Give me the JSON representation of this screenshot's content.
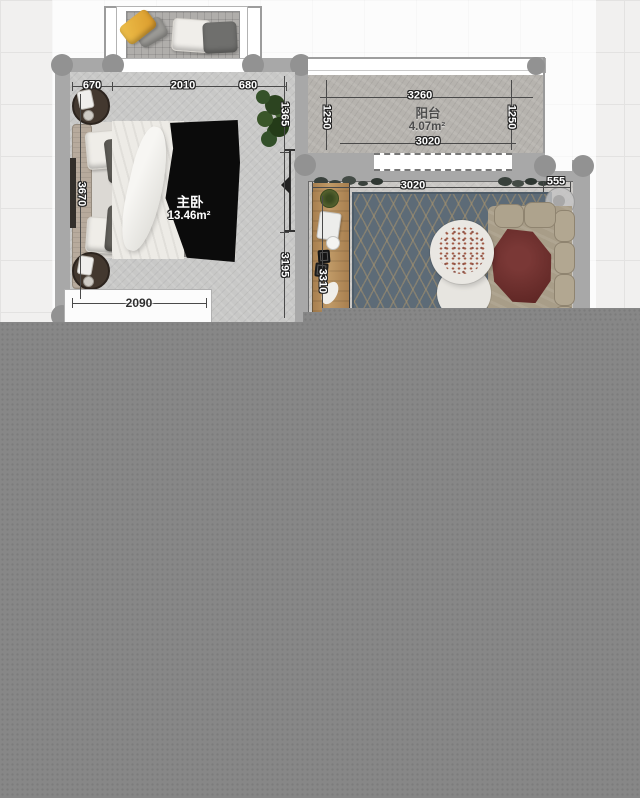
{
  "floorplan": {
    "bedroom": {
      "name": "主卧",
      "area": "13.46m²",
      "dim_top_left": "670",
      "dim_top_center": "2010",
      "dim_top_right": "680",
      "dim_left": "3670",
      "dim_right_upper": "1365",
      "dim_right_lower": "3195",
      "dim_bottom": "2090"
    },
    "balcony": {
      "name": "阳台",
      "area": "4.07m²",
      "dim_top": "3260",
      "dim_left": "1250",
      "dim_right": "1250",
      "dim_bottom": "3020"
    },
    "living_room": {
      "dim_top": "3020",
      "dim_right": "555",
      "dim_left": "3310"
    }
  },
  "colors": {
    "wall": "#a8a8a8",
    "bedroom_floor": "#c8c8c7",
    "balcony_floor": "#b6b3ae",
    "living_floor": "#cac8c5",
    "rug": "#5d6b77",
    "rug_lattice": "#aa946c",
    "sofa": "#a89d88",
    "throw_blanket": "#6b2d2b",
    "cabinet_wood": "#b5905e",
    "pillow_yellow": "#e0a23d",
    "overlay": "#878787"
  }
}
